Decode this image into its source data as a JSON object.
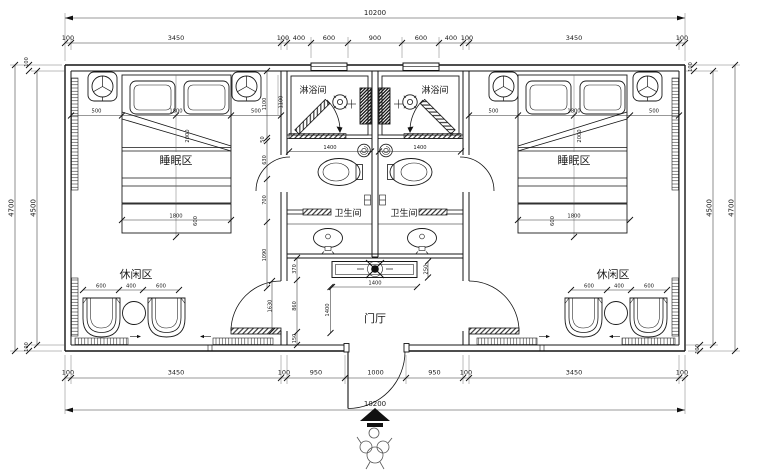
{
  "rooms": {
    "sleeping": "睡眠区",
    "shower": "淋浴间",
    "toilet": "卫生间",
    "leisure": "休闲区",
    "hall": "门厅"
  },
  "dims": {
    "overall": "10200",
    "top_chain": [
      "100",
      "3450",
      "100",
      "400",
      "600",
      "900",
      "600",
      "400",
      "100",
      "3450",
      "100"
    ],
    "bottom_chain": [
      "100",
      "3450",
      "100",
      "950",
      "1000",
      "950",
      "100",
      "3450",
      "100"
    ],
    "left_outer": "4700",
    "left_inner": "4500",
    "right_inner": "4500",
    "right_outer": "4700",
    "wall_100": "100",
    "bed_width": [
      "500",
      "1800",
      "500"
    ],
    "bed_length": "2000",
    "bench_width": "1800",
    "bench_depth": "600",
    "seating": [
      "600",
      "400",
      "600"
    ],
    "shower_width": "1400",
    "console_width": "1400",
    "console_depth": "250",
    "hall_depth": "1400",
    "hall_side_chain": [
      "370",
      "860",
      "150"
    ],
    "bath_side_chain": [
      "1100",
      "50",
      "630",
      "700",
      "1090"
    ],
    "door_width": "1630",
    "nightstand": "1100"
  }
}
